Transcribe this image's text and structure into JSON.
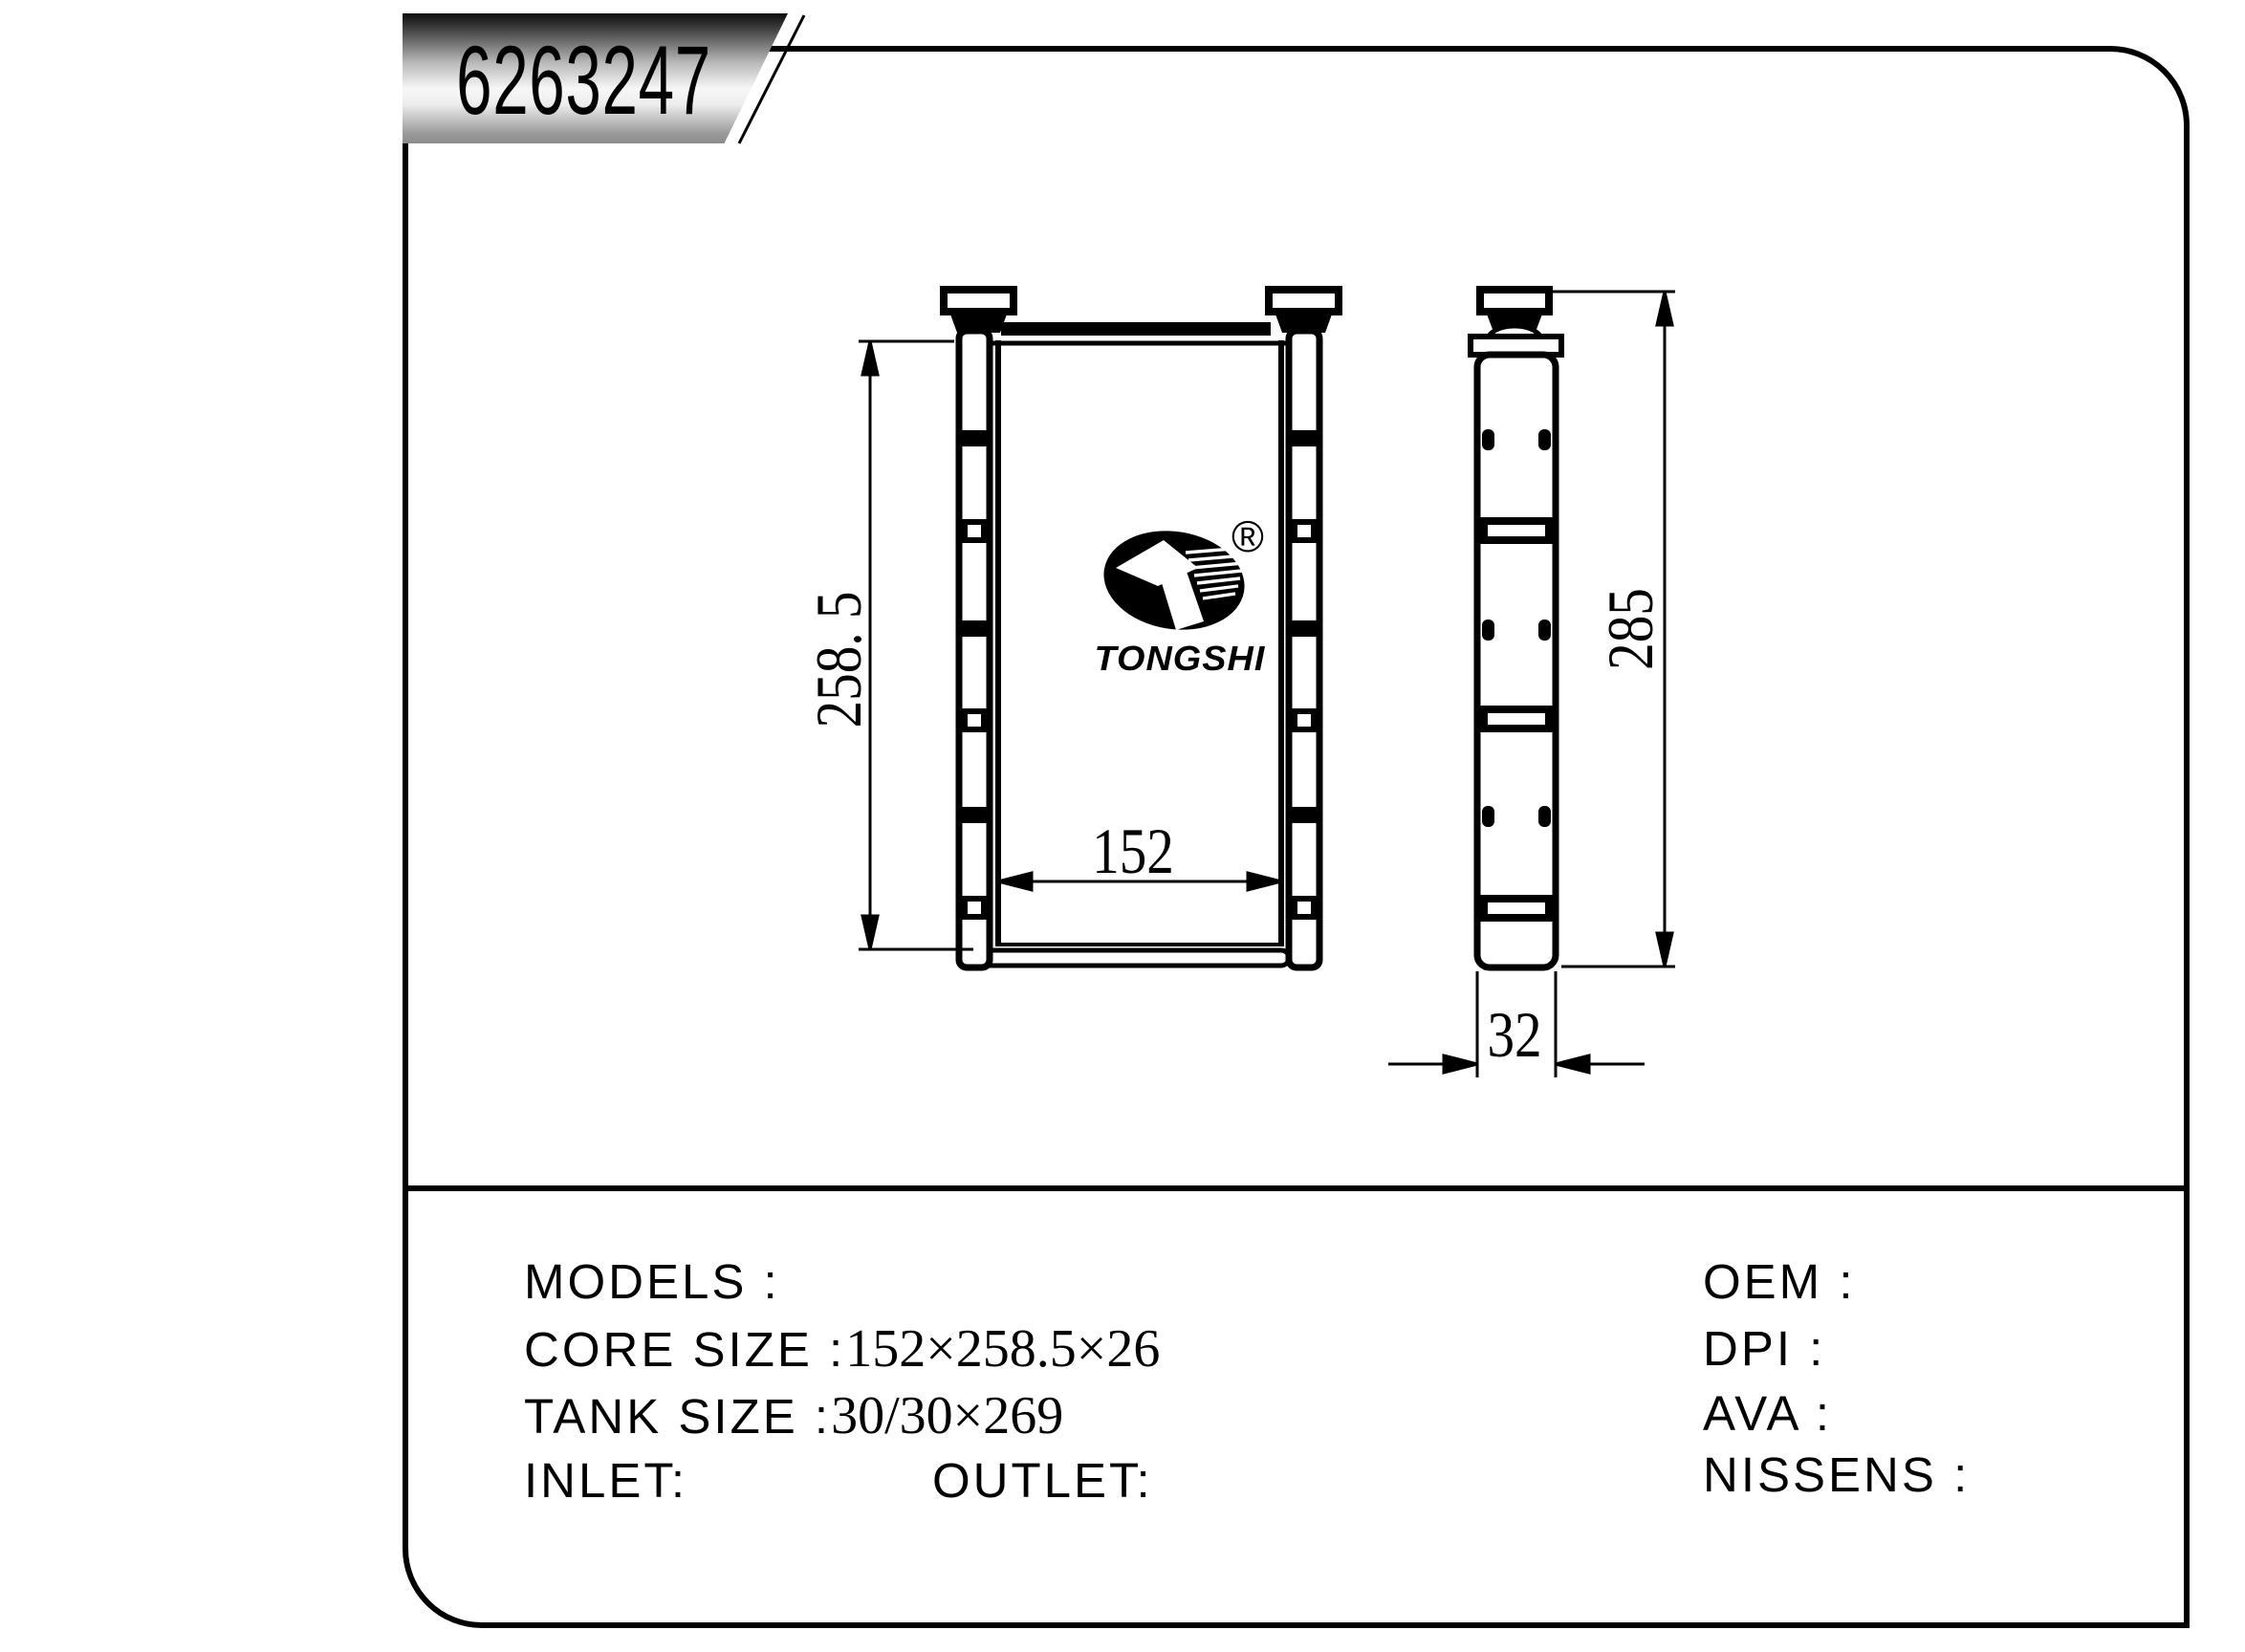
{
  "badge": {
    "part_number": "6263247"
  },
  "logo": {
    "brand": "TONGSHI",
    "registered_mark": "®"
  },
  "dimensions": {
    "core_height": "258. 5",
    "core_width": "152",
    "overall_height": "285",
    "tank_depth": "32"
  },
  "spec_table": {
    "models_label": "MODELS :",
    "core_size_label": "CORE SIZE :",
    "core_size_value": "152×258.5×26",
    "tank_size_label": "TANK SIZE :",
    "tank_size_value": "30/30×269",
    "inlet_label": "INLET:",
    "outlet_label": "OUTLET:",
    "oem_label": "OEM :",
    "dpi_label": "DPI :",
    "ava_label": "AVA :",
    "nissens_label": "NISSENS :"
  },
  "colors": {
    "line": "#000000",
    "background": "#ffffff"
  }
}
